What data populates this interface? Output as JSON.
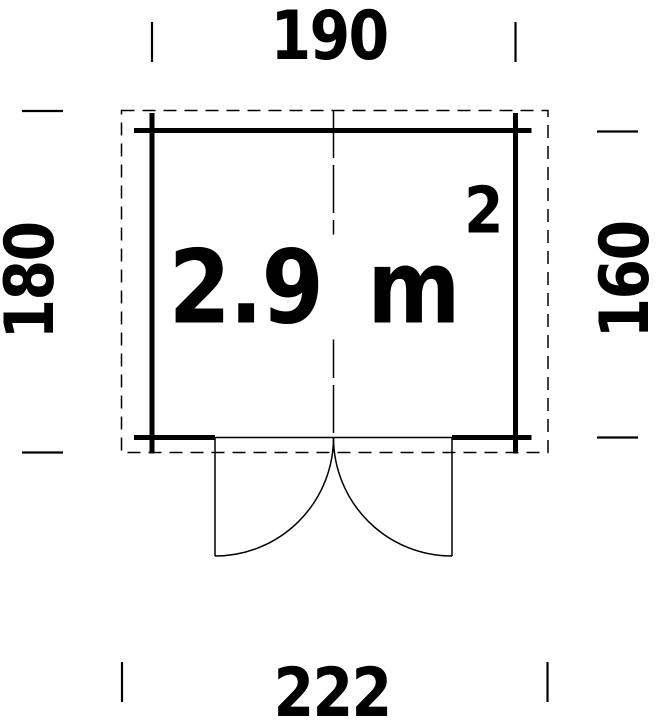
{
  "plan": {
    "area_label": {
      "value": "2.9",
      "unit": "m",
      "exponent": "2"
    },
    "dimensions": {
      "top": "190",
      "right": "160",
      "bottom": "222",
      "left": "180"
    },
    "colors": {
      "line": "#000000",
      "text": "#000000",
      "background": "#ffffff"
    }
  }
}
